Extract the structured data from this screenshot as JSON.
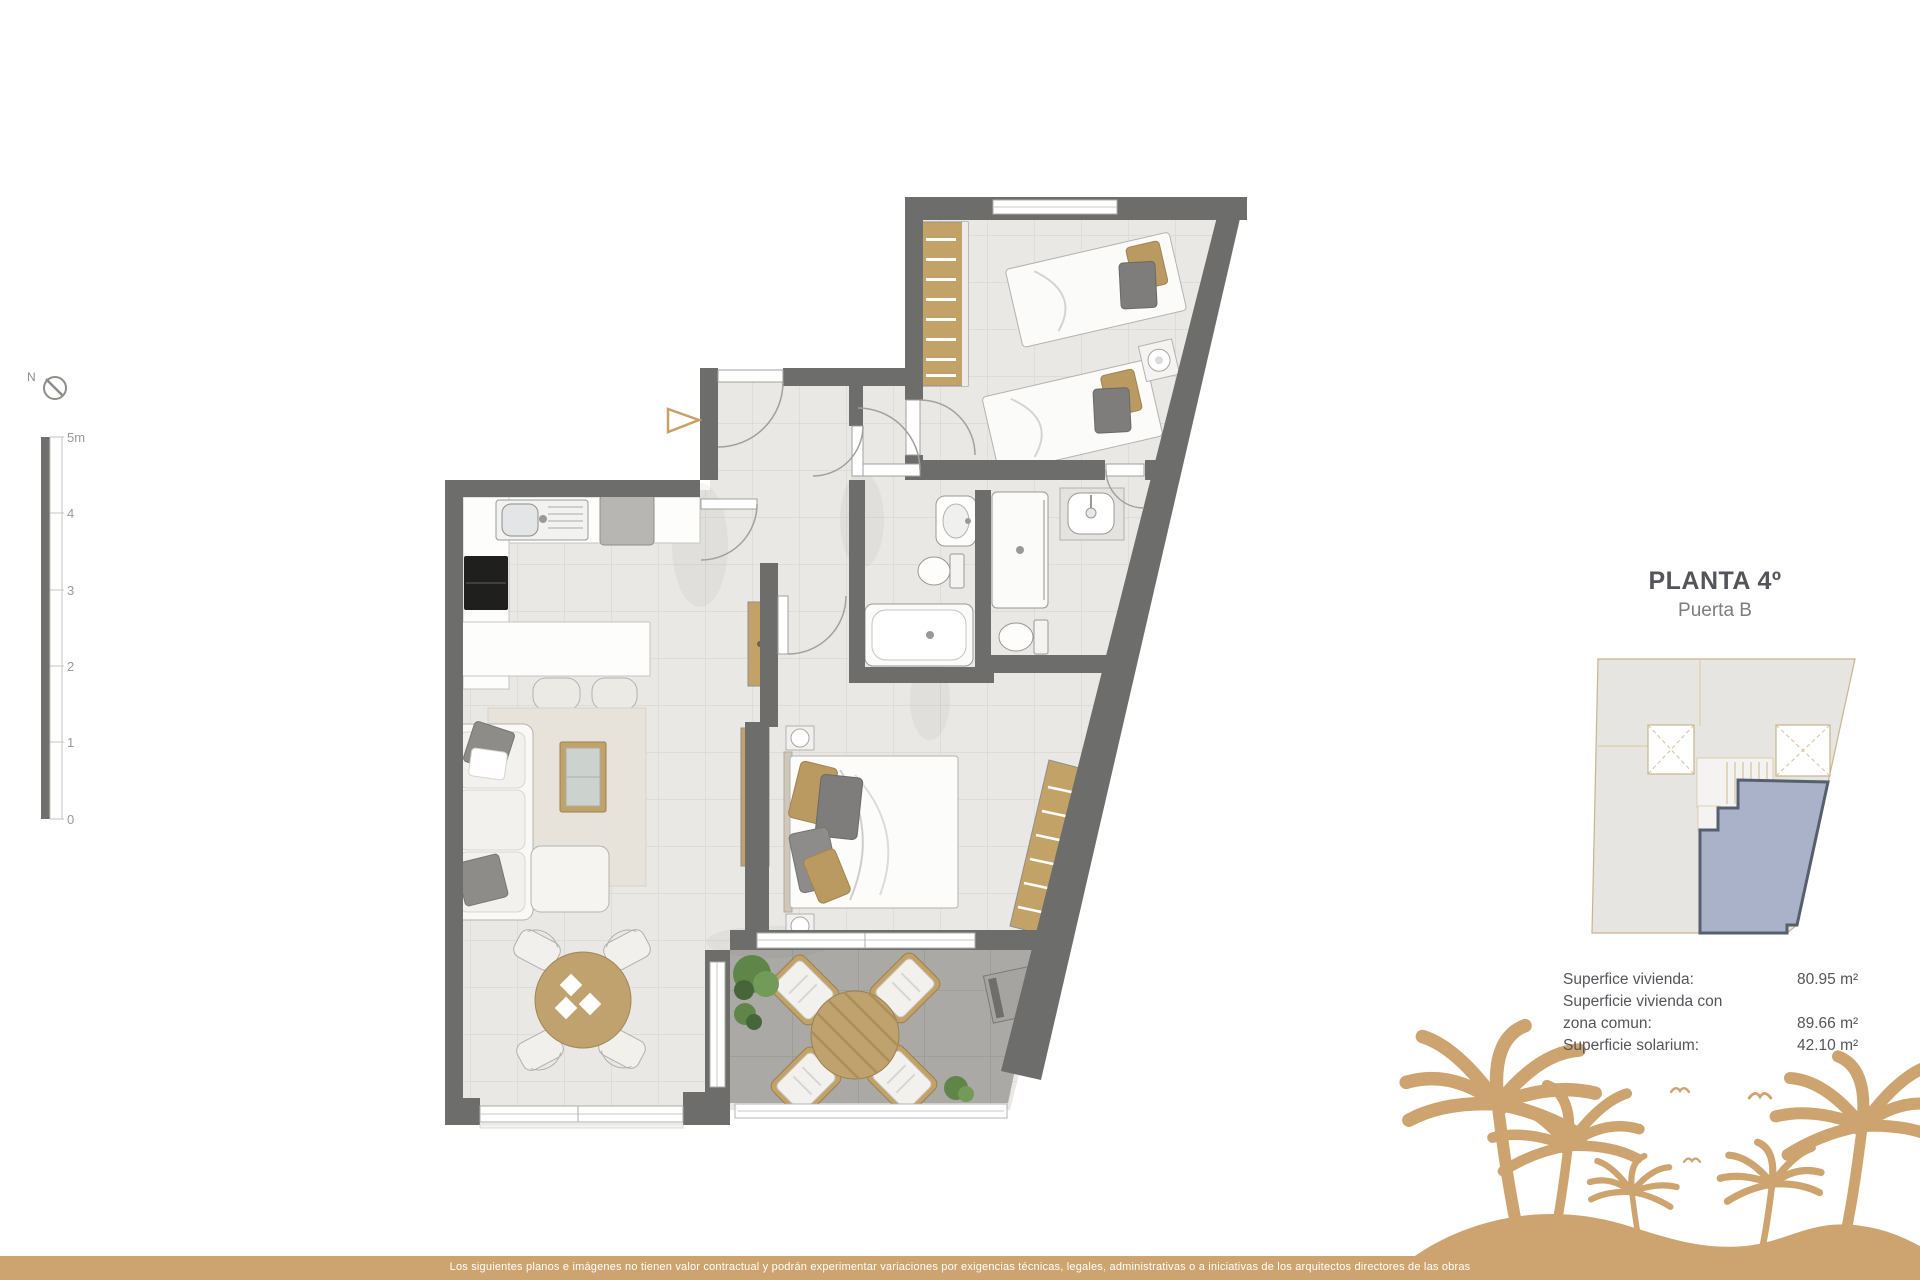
{
  "title_block": {
    "title": "PLANTA 4º",
    "subtitle": "Puerta B"
  },
  "areas": {
    "rows": [
      {
        "lines": [
          "Superfice vivienda:"
        ],
        "value": "80.95 m²"
      },
      {
        "lines": [
          "Superficie vivienda con",
          "zona comun:"
        ],
        "value": "89.66 m²"
      },
      {
        "lines": [
          "Superficie solarium:"
        ],
        "value": "42.10 m²"
      }
    ]
  },
  "scale_bar": {
    "labels": [
      "5m",
      "4",
      "3",
      "2",
      "1",
      "0"
    ]
  },
  "compass": {
    "label": "N"
  },
  "footer": {
    "disclaimer": "Los siguientes planos e imágenes no tienen valor contractual y podrán experimentar variaciones por exigencias técnicas, legales, administrativas o a iniciativas de los arquitectos directores de las obras"
  },
  "colors": {
    "wall": "#6d6d6b",
    "wood": "#c3a268",
    "brand_tan": "#cda46f",
    "floor": "#e9e8e5",
    "terrace_floor": "#aaa9a5",
    "keyplan_unit_fill": "#a9b2c8",
    "keyplan_unit_stroke": "#565f6e",
    "plant_green": "#5f8549"
  }
}
